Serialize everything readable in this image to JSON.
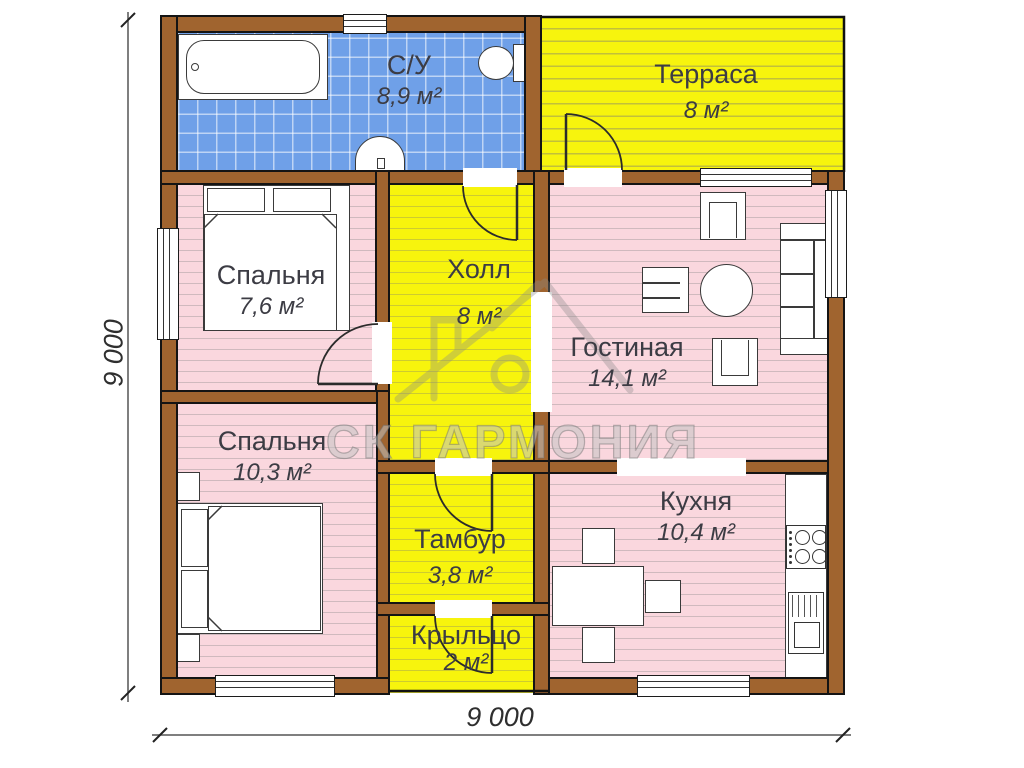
{
  "plan": {
    "title": "Планировка дома 9х9",
    "watermark": {
      "text": "СК ГАРМОНИЯ"
    },
    "dimensions": {
      "bottom": "9 000",
      "left": "9 000"
    },
    "rooms": [
      {
        "id": "bathroom",
        "name": "С/У",
        "area": "8,9 м²",
        "color": "#6FA0E8"
      },
      {
        "id": "terrace",
        "name": "Терраса",
        "area": "8 м²",
        "color": "#F7F40D"
      },
      {
        "id": "bedroom-1",
        "name": "Спальня",
        "area": "7,6 м²",
        "color": "#FAD7DE"
      },
      {
        "id": "hall",
        "name": "Холл",
        "area": "8 м²",
        "color": "#F7F40D"
      },
      {
        "id": "living-room",
        "name": "Гостиная",
        "area": "14,1 м²",
        "color": "#FAD7DE"
      },
      {
        "id": "bedroom-2",
        "name": "Спальня",
        "area": "10,3 м²",
        "color": "#FAD7DE"
      },
      {
        "id": "vestibule",
        "name": "Тамбур",
        "area": "3,8 м²",
        "color": "#F7F40D"
      },
      {
        "id": "kitchen",
        "name": "Кухня",
        "area": "10,4 м²",
        "color": "#FAD7DE"
      },
      {
        "id": "porch",
        "name": "Крыльцо",
        "area": "2 м²",
        "color": "#F7F40D"
      }
    ],
    "colors": {
      "wall": "#A0642F",
      "tile_blue": "#6FA0E8",
      "floor_pink": "#FAD7DE",
      "floor_yellow": "#F7F40D"
    }
  }
}
